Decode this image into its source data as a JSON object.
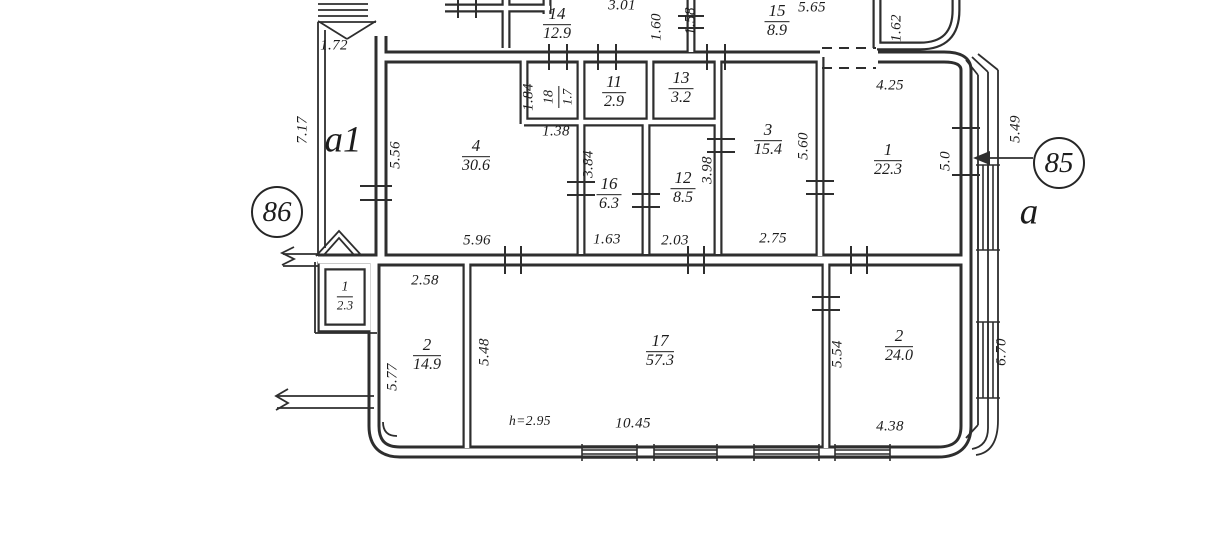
{
  "markers": {
    "m86": "86",
    "m85": "85"
  },
  "letters": {
    "a1": "a1",
    "a": "a"
  },
  "rooms": {
    "r14": {
      "number": "14",
      "area": "12.9"
    },
    "r15": {
      "number": "15",
      "area": "8.9"
    },
    "r18": {
      "number": "18",
      "area": "1.7"
    },
    "r11": {
      "number": "11",
      "area": "2.9"
    },
    "r13": {
      "number": "13",
      "area": "3.2"
    },
    "r4": {
      "number": "4",
      "area": "30.6"
    },
    "r16": {
      "number": "16",
      "area": "6.3"
    },
    "r12": {
      "number": "12",
      "area": "8.5"
    },
    "r3": {
      "number": "3",
      "area": "15.4"
    },
    "r1": {
      "number": "1",
      "area": "22.3"
    },
    "r1s": {
      "number": "1",
      "area": "2.3"
    },
    "r2a": {
      "number": "2",
      "area": "14.9"
    },
    "r17": {
      "number": "17",
      "area": "57.3"
    },
    "r2b": {
      "number": "2",
      "area": "24.0"
    }
  },
  "dims": {
    "d1_72": "1.72",
    "d7_17": "7.17",
    "d3_01": "3.01",
    "d1_60": "1.60",
    "d1_58": "1.58",
    "d5_65": "5.65",
    "d1_62": "1.62",
    "d4_25": "4.25",
    "d5_49": "5.49",
    "d5_0": "5.0",
    "d5_56": "5.56",
    "d1_84": "1.84",
    "d1_38": "1.38",
    "d3_84": "3.84",
    "d3_98": "3.98",
    "d5_60": "5.60",
    "d5_96": "5.96",
    "d1_63": "1.63",
    "d2_03": "2.03",
    "d2_75": "2.75",
    "d2_58": "2.58",
    "d5_77": "5.77",
    "d5_48": "5.48",
    "d5_54": "5.54",
    "d6_70": "6.70",
    "d10_45": "10.45",
    "d4_38": "4.38"
  },
  "notes": {
    "height": "h=2.95"
  }
}
